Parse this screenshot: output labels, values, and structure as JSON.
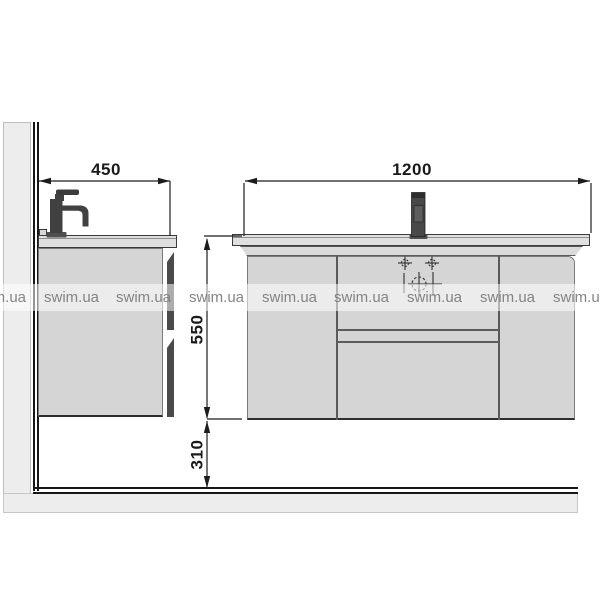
{
  "watermark": {
    "text": "swim.ua"
  },
  "dimensions": {
    "side_depth": "450",
    "front_width": "1200",
    "cabinet_height": "550",
    "floor_clearance": "310"
  },
  "colors": {
    "line": "#1c1c1c",
    "wall_fill": "#ededed",
    "cabinet_fill": "#d5d5d5",
    "countertop_fill": "#e0e0e0",
    "faucet_fill": "#454545",
    "watermark_text": "#7d7d7d"
  }
}
